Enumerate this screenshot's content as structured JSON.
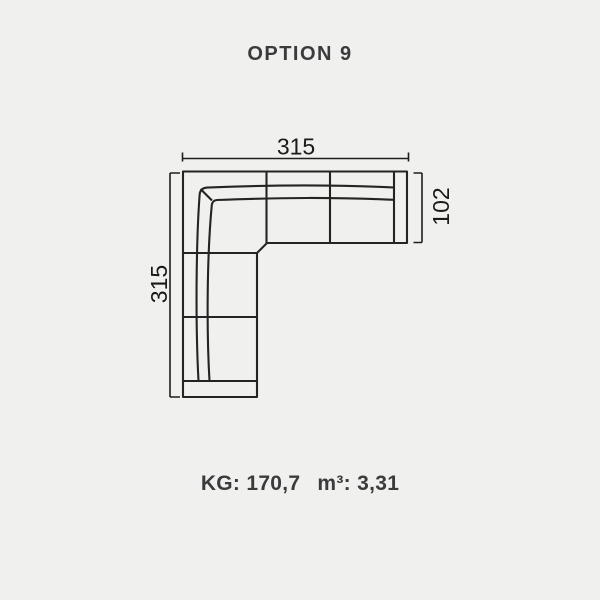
{
  "title": "OPTION 9",
  "diagram": {
    "description": "corner-sofa-top-view",
    "dimensions": {
      "top_width": "315",
      "left_height": "315",
      "right_arm_depth": "102"
    }
  },
  "specs": {
    "weight": "KG: 170,7",
    "volume": "m³: 3,31"
  },
  "colors": {
    "background": "#f0f0ef",
    "line": "#242424",
    "dimension_line": "#1f1f1f",
    "dimension_text": "#1a1a1a",
    "heading_text": "#3b3b3d"
  }
}
